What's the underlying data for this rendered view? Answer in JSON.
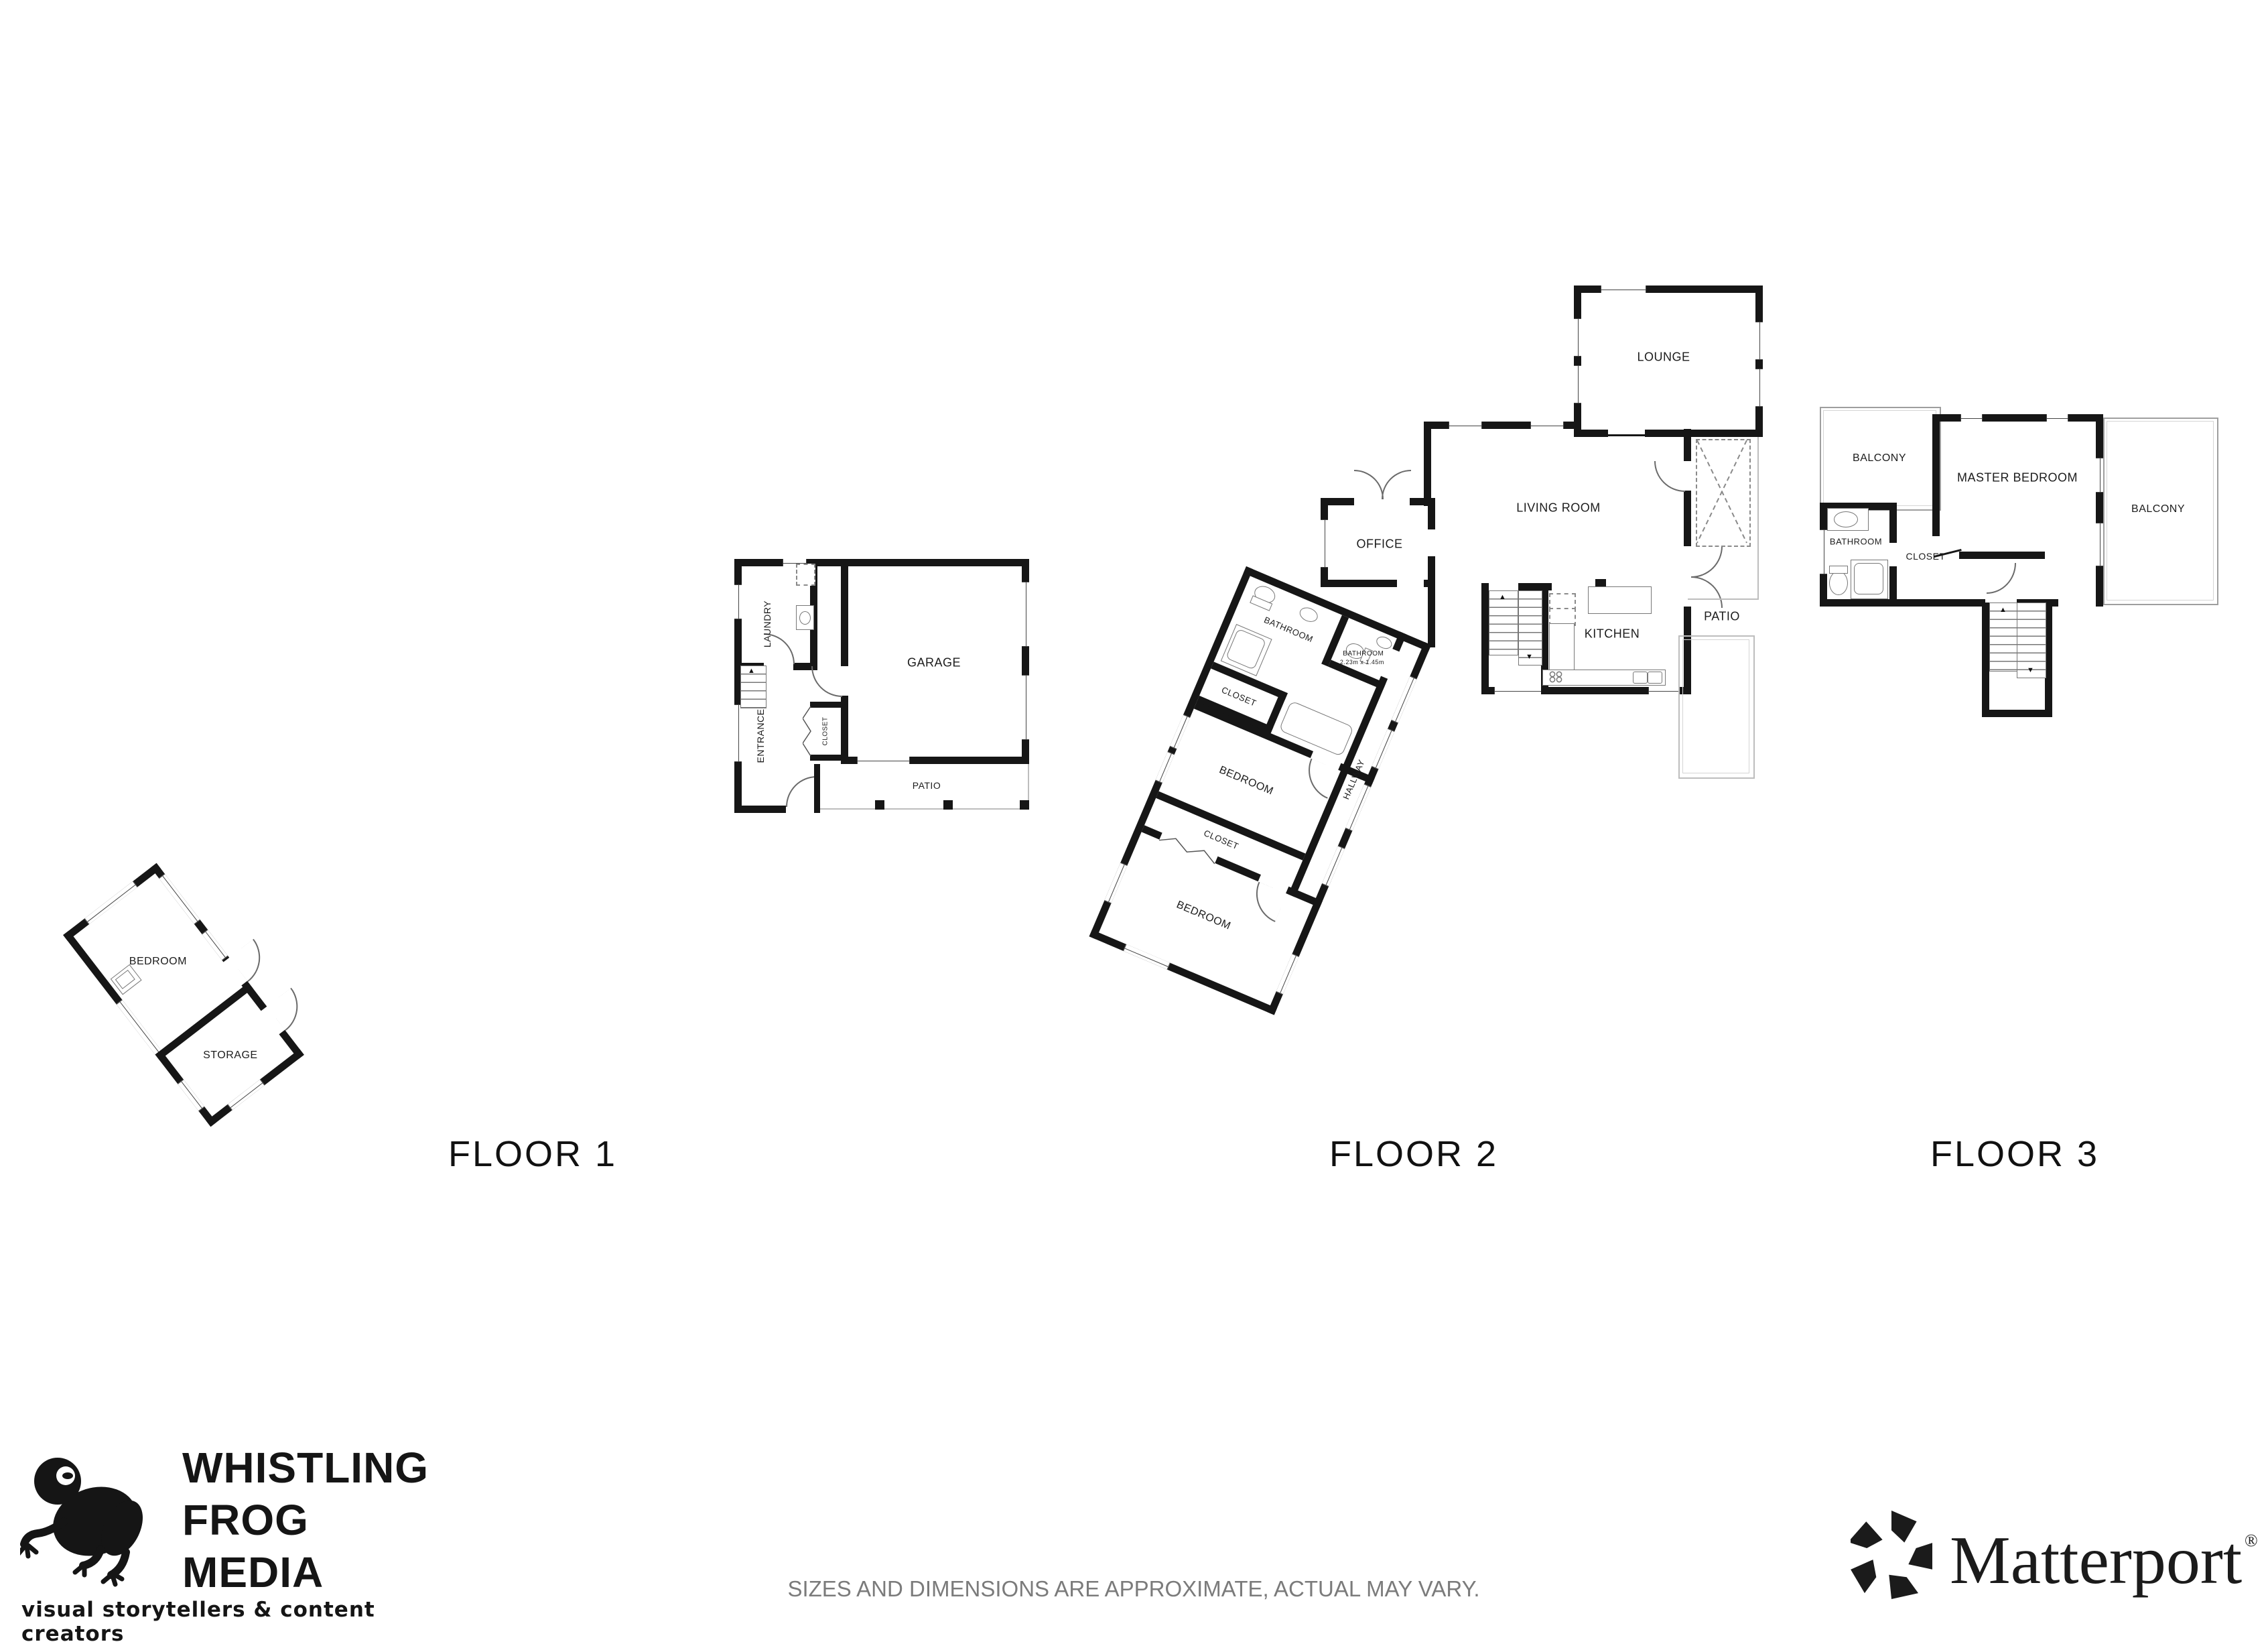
{
  "floors": {
    "f1": {
      "label": "FLOOR 1",
      "rooms": {
        "bedroom": "BEDROOM",
        "storage": "STORAGE",
        "laundry": "LAUNDRY",
        "garage": "GARAGE",
        "entrance": "ENTRANCE",
        "closet": "CLOSET",
        "patio": "PATIO"
      }
    },
    "f2": {
      "label": "FLOOR 2",
      "rooms": {
        "lounge": "LOUNGE",
        "living_room": "LIVING ROOM",
        "office": "OFFICE",
        "kitchen": "KITCHEN",
        "patio": "PATIO",
        "bathroom": "BATHROOM",
        "bathroom2": "BATHROOM",
        "bathroom2_dims": "2.23m x 1.45m",
        "closet1": "CLOSET",
        "bedroom1": "BEDROOM",
        "closet2": "CLOSET",
        "bedroom2": "BEDROOM",
        "hallway": "HALLWAY"
      }
    },
    "f3": {
      "label": "FLOOR 3",
      "rooms": {
        "balcony_left": "BALCONY",
        "master_bedroom": "MASTER BEDROOM",
        "balcony_right": "BALCONY",
        "bathroom": "BATHROOM",
        "closet": "CLOSET"
      }
    }
  },
  "icons": {
    "arrow_up": "▲",
    "arrow_down": "▼"
  },
  "branding": {
    "whistling_frog": {
      "line1": "WHISTLING",
      "line2": "FROG",
      "line3": "MEDIA",
      "tagline": "visual storytellers & content creators"
    },
    "matterport": {
      "name": "Matterport",
      "registered": "®"
    }
  },
  "disclaimer": "SIZES AND DIMENSIONS ARE APPROXIMATE, ACTUAL MAY VARY.",
  "colors": {
    "wall": "#161616",
    "thin_line": "#bdbdbd",
    "disclaimer_text": "#7b7b7b"
  }
}
